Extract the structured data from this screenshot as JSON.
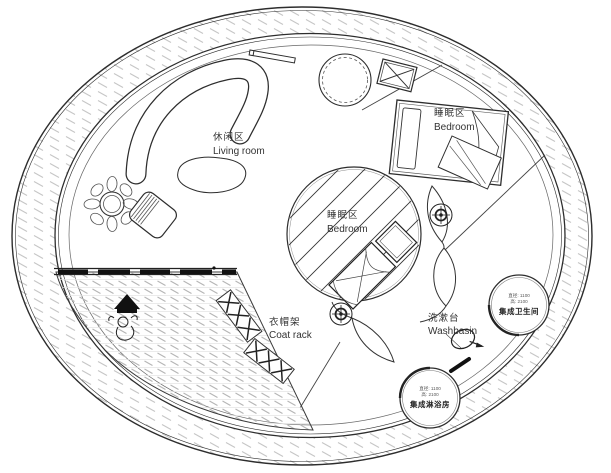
{
  "plan": {
    "labels": {
      "living_room": {
        "zh": "休闲区",
        "en": "Living room"
      },
      "bedroom_upper": {
        "zh": "睡眠区",
        "en": "Bedroom"
      },
      "bedroom_center": {
        "zh": "睡眠区",
        "en": "Bedroom"
      },
      "coat_rack": {
        "zh": "衣帽架",
        "en": "Coat rack"
      },
      "washbasin": {
        "zh": "洗漱台",
        "en": "Washbasin"
      },
      "bathroom_pod": {
        "dims_line1": "直径: 1100",
        "dims_line2": "高: 2100",
        "name": "集成卫生间"
      },
      "shower_pod": {
        "dims_line1": "直径: 1100",
        "dims_line2": "高: 2100",
        "name": "集成淋浴房"
      }
    },
    "symbols": [
      "column-marker-icon",
      "plant-icon",
      "entry-arrow-icon",
      "person-icon",
      "washbasin-icon",
      "door-dash-icon",
      "vent-box-icon",
      "round-table-icon",
      "coat-rack-icon",
      "sofa-icon",
      "bed-icon",
      "rug-icon",
      "chair-icon"
    ],
    "colors": {
      "line": "#2d2d2d",
      "hatch_light": "#c6c6c6",
      "hatch_dark": "#b5b5b5",
      "black_fill": "#111111",
      "background": "#ffffff"
    }
  }
}
